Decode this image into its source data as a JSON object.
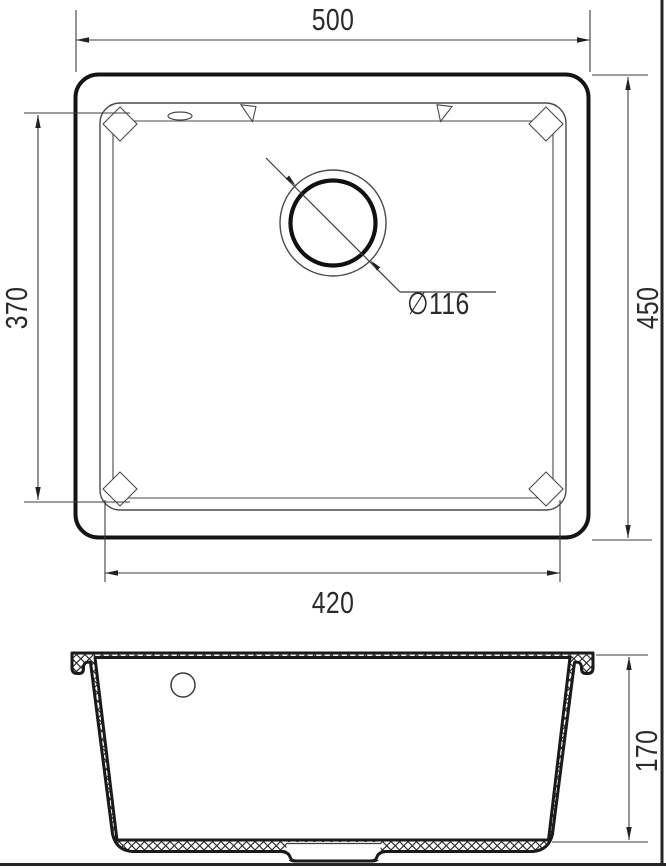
{
  "drawing": {
    "dimensions": {
      "top_width": "500",
      "overall_depth": "450",
      "bowl_depth_top": "370",
      "bowl_width_bottom": "420",
      "drain_diameter": "∅116",
      "bowl_height": "170"
    },
    "colors": {
      "thin_line": "#3d3d3d",
      "heavy_line": "#161616",
      "text": "#2b2b2b",
      "background": "#ffffff"
    }
  }
}
